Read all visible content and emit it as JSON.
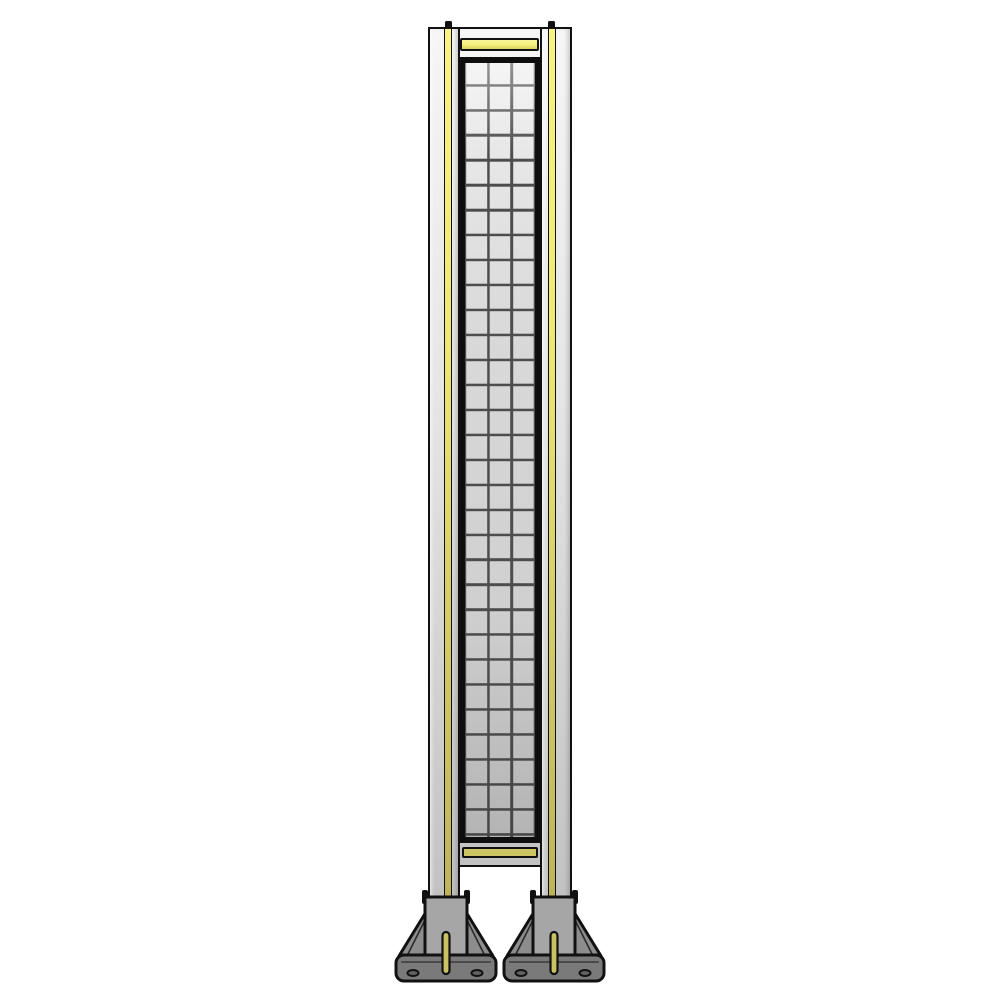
{
  "scene": {
    "object": "wire-mesh-guard-panel-with-mounting-feet",
    "background": "plain-white",
    "text_visible": "none"
  },
  "colors": {
    "background": "#ffffff",
    "outline": "#111111",
    "frame_light": "#f6f6f6",
    "frame_mid": "#e4e4e4",
    "frame_dark": "#c2c2c2",
    "stripe_yellow_light": "#f8f482",
    "stripe_yellow_dark": "#beb458",
    "bar_yellow_bright": "#f4ef78",
    "bar_yellow_olive": "#ccc462",
    "mesh_bg_light": "#eeeeee",
    "mesh_bg_dark": "#c8c8c8",
    "mesh_wire": "#4d4d4d",
    "foot_gray_light": "#a6a6a6",
    "foot_gray_mid": "#8d8d8d",
    "foot_gray_dark": "#7a7a7a",
    "slot_olive": "#c9c162"
  },
  "mesh": {
    "columns": 3,
    "rows": 31
  },
  "stripes": {
    "vertical_posts_with_yellow_strip": 2,
    "horizontal_yellow_bars": 2
  },
  "feet": {
    "count": 2,
    "bolt_holes_visible_per_foot": 2,
    "yellow_slots_per_foot": 1
  }
}
